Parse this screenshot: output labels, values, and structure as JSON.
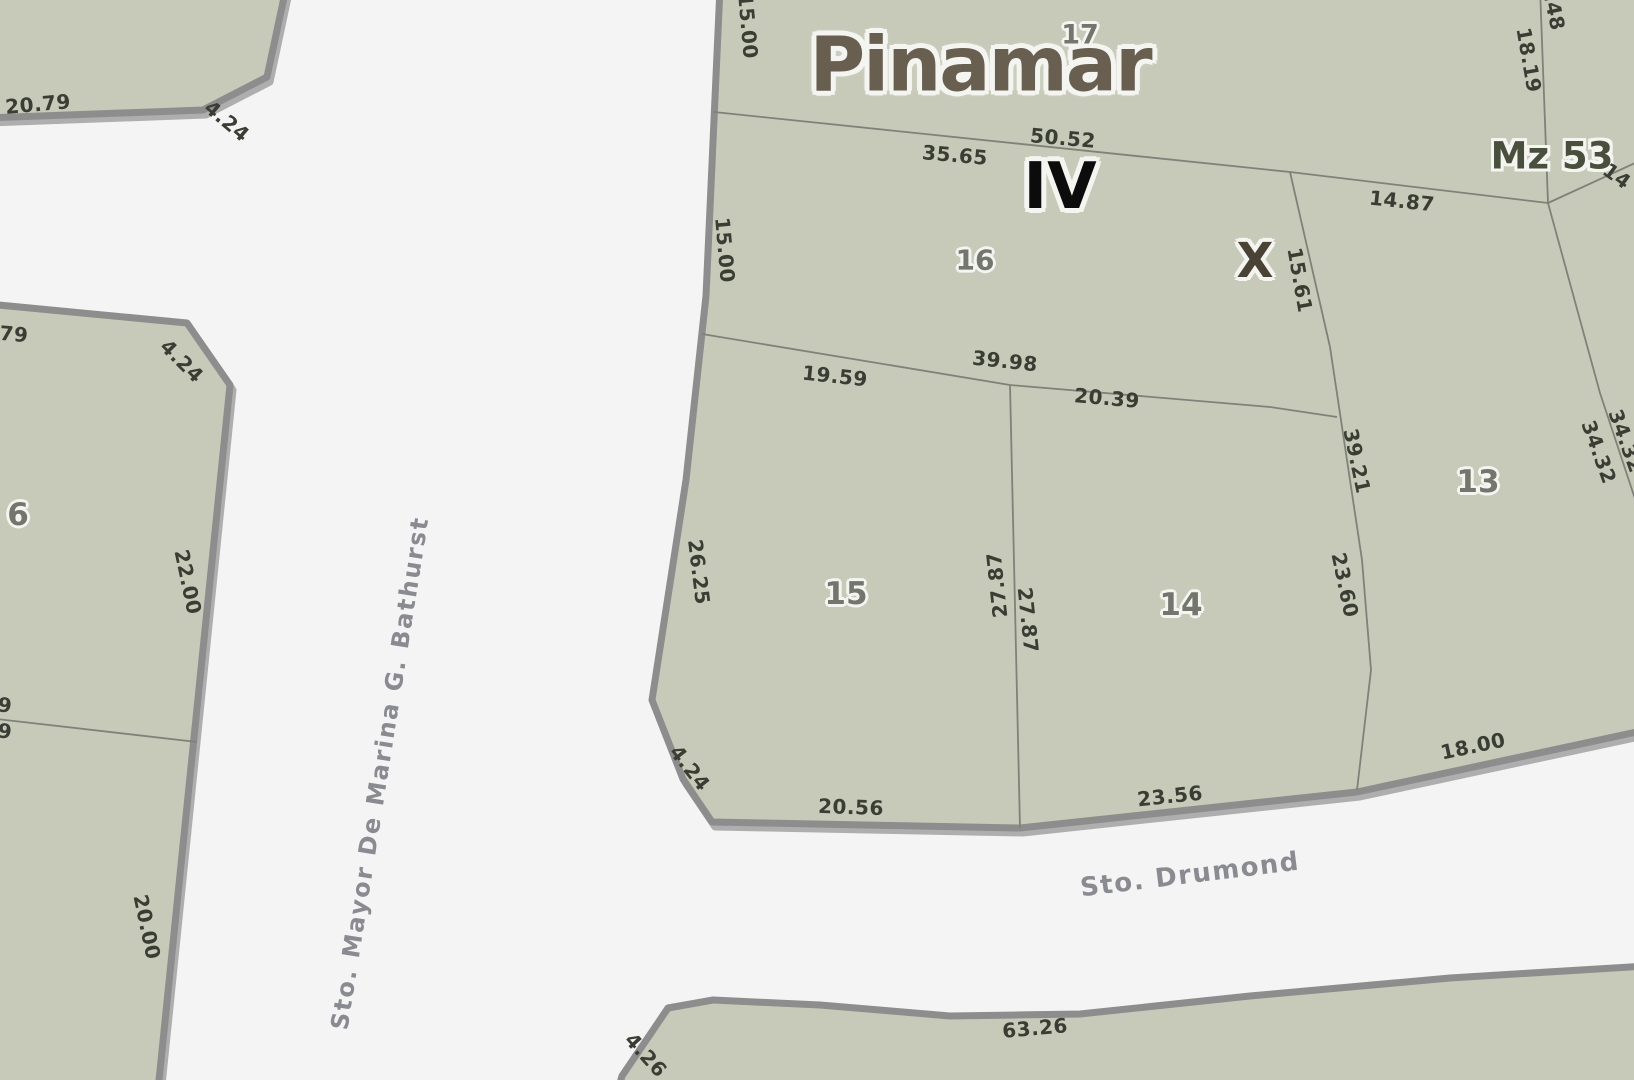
{
  "map": {
    "title": "Pinamar",
    "manzana_label": "Mz 53",
    "zone_label": "IV",
    "marker_label": "X",
    "streets": {
      "vertical": "Sto. Mayor De Marina G. Bathurst",
      "bottom": "Sto. Drumond"
    },
    "parcels": [
      {
        "number": "17"
      },
      {
        "number": "16"
      },
      {
        "number": "15"
      },
      {
        "number": "14"
      },
      {
        "number": "13"
      },
      {
        "number": "6"
      }
    ],
    "dimensions": [
      {
        "t": "15.00"
      },
      {
        "t": "15.00"
      },
      {
        "t": "26.25"
      },
      {
        "t": "4.24"
      },
      {
        "t": "20.56"
      },
      {
        "t": "23.56"
      },
      {
        "t": "18.00"
      },
      {
        "t": "35.65"
      },
      {
        "t": "50.52"
      },
      {
        "t": "14.87"
      },
      {
        "t": "18.19"
      },
      {
        "t": "4.48"
      },
      {
        "t": "14"
      },
      {
        "t": "15.61"
      },
      {
        "t": "19.59"
      },
      {
        "t": "39.98"
      },
      {
        "t": "20.39"
      },
      {
        "t": "39.21"
      },
      {
        "t": "23.60"
      },
      {
        "t": "27.87"
      },
      {
        "t": "27.87"
      },
      {
        "t": "34.32"
      },
      {
        "t": "34.32"
      },
      {
        "t": "22.00"
      },
      {
        "t": "20.00"
      },
      {
        "t": "20.79"
      },
      {
        "t": "4.24"
      },
      {
        "t": "79"
      },
      {
        "t": "4.24"
      },
      {
        "t": "9"
      },
      {
        "t": "9"
      },
      {
        "t": "63.26"
      },
      {
        "t": "4.26"
      }
    ]
  },
  "colors": {
    "street_bg": "#f4f4f5",
    "parcel_fill": "#c7cab9",
    "border": "#8d8d8d",
    "border_shadow": "#aeaeae",
    "line": "#7f8278",
    "dim_text": "#3a3d33",
    "parcel_number": "#73766c",
    "title": "#695f50",
    "zone": "#0c0c0c",
    "marker": "#4b4236",
    "manzana": "#48503d",
    "street_text": "#8a8a91",
    "halo": "#f4f4f1"
  }
}
